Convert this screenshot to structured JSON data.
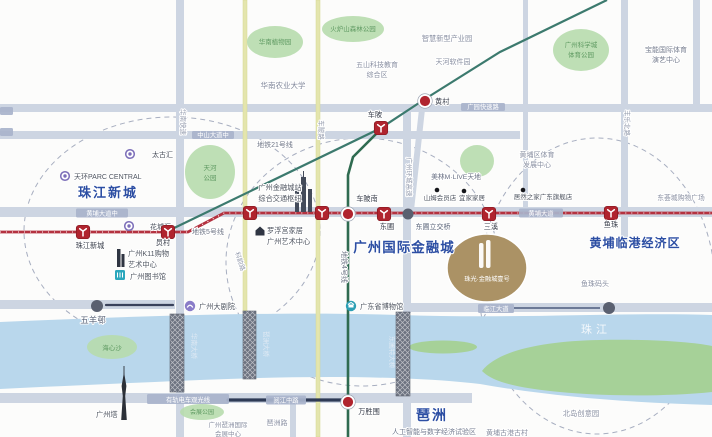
{
  "palette": {
    "road": "#cdd5e2",
    "yellow_road": "#e4e5ad",
    "yellow_edge": "#d6d792",
    "river": "#b9d7ec",
    "island": "#a6d198",
    "park": "#b7dcad",
    "park_text": "#5f9a62",
    "badge": "#a9b4cb",
    "line5": "#b43240",
    "line4": "#2f6b50",
    "line21": "#3c7a6e",
    "tram": "#2e3a55",
    "station_red": "#b0242e",
    "blue_label": "#2c4ea3",
    "gold": "#ab9265",
    "dash": "#a7aec0",
    "gray_text": "#8a90a2",
    "dark_text": "#4e545f",
    "station_text": "#3b404c",
    "vtext": "#959cae",
    "bridge": "#6c7280",
    "dot": "#5a6070",
    "white_text": "#f4f8fc",
    "bridge_text": "#e0eaf4"
  },
  "dashed_circles": [
    {
      "id": "district-circle-zhujiang-new-town",
      "cx": 172,
      "cy": 231,
      "rx": 148,
      "ry": 114
    },
    {
      "id": "district-circle-financial-city",
      "cx": 362,
      "cy": 262,
      "rx": 136,
      "ry": 124
    },
    {
      "id": "district-circle-huangpu-port",
      "cx": 597,
      "cy": 286,
      "rx": 118,
      "ry": 148
    }
  ],
  "roads_under": [
    {
      "id": "road-guangyuan-expressway",
      "kind": "rect",
      "x": 0,
      "y": 104,
      "w": 712,
      "h": 8
    },
    {
      "id": "road-zhongshan-avenue-middle",
      "kind": "rect",
      "x": 0,
      "y": 131,
      "w": 520,
      "h": 8
    },
    {
      "id": "road-huangpu-avenue",
      "kind": "rect",
      "x": 0,
      "y": 207,
      "w": 712,
      "h": 10
    },
    {
      "id": "road-wuyangcun",
      "kind": "rect",
      "x": 0,
      "y": 300,
      "w": 175,
      "h": 9
    },
    {
      "id": "road-huanan-expressway",
      "kind": "rect",
      "x": 176,
      "y": 0,
      "w": 8,
      "h": 316
    },
    {
      "id": "road-ring-expressway",
      "kind": "rect",
      "x": 403,
      "y": 108,
      "w": 8,
      "h": 205
    },
    {
      "id": "road-fengle-north-road",
      "kind": "rect",
      "x": 621,
      "y": 0,
      "w": 7,
      "h": 245
    },
    {
      "id": "road-right-edge",
      "kind": "rect",
      "x": 693,
      "y": 0,
      "w": 7,
      "h": 110
    },
    {
      "id": "road-dashadi",
      "kind": "rect",
      "x": 523,
      "y": 0,
      "w": 5,
      "h": 210
    },
    {
      "id": "road-huangcun-link",
      "kind": "line",
      "x1": 423,
      "y1": 100,
      "x2": 411,
      "y2": 210,
      "w": 6
    },
    {
      "id": "road-keyun-road",
      "kind": "yrect",
      "x": 243,
      "y": 0,
      "w": 4,
      "h": 312
    }
  ],
  "roads_over": [
    {
      "id": "road-linjiang-avenue",
      "kind": "rect",
      "x": 405,
      "y": 303,
      "w": 307,
      "h": 9
    },
    {
      "id": "road-yuejiang-road",
      "kind": "rect",
      "x": 0,
      "y": 393,
      "w": 472,
      "h": 10
    },
    {
      "id": "road-huanan-expressway-south",
      "kind": "rect",
      "x": 176,
      "y": 392,
      "w": 8,
      "h": 45
    },
    {
      "id": "road-ring-expressway-south",
      "kind": "rect",
      "x": 403,
      "y": 395,
      "w": 8,
      "h": 42
    },
    {
      "id": "road-pazhou-vertical",
      "kind": "rect",
      "x": 290,
      "y": 403,
      "w": 6,
      "h": 34
    },
    {
      "id": "road-chebei-road",
      "kind": "yrect",
      "x": 316,
      "y": 0,
      "w": 4,
      "h": 437
    }
  ],
  "river": {
    "id": "pearl-river",
    "path": "M0,322 C140,316 280,311 400,315 C520,319 620,312 712,315 L712,405 C640,403 560,398 480,384 C400,375 300,376 200,380 C130,383 60,386 0,389 Z",
    "islands": [
      {
        "id": "island-dajisha",
        "kind": "path",
        "path": "M482,371 C498,350 545,341 600,340 C652,339 692,342 712,346 L712,392 C664,397 602,396 560,392 C520,388 494,383 482,371 Z"
      },
      {
        "id": "island-sliver",
        "kind": "ellipse",
        "cx": 443,
        "cy": 347,
        "rx": 34,
        "ry": 6.5
      }
    ]
  },
  "bridges": [
    {
      "id": "huanan-bridge",
      "label": "华南大桥",
      "x": 170,
      "y": 314,
      "w": 14,
      "h": 78,
      "lx": 192,
      "ly": 346
    },
    {
      "id": "pazhou-bridge",
      "label": "琶洲大桥",
      "x": 243,
      "y": 311,
      "w": 13,
      "h": 68,
      "lx": 264,
      "ly": 344
    },
    {
      "id": "dongpu-bridge",
      "label": "东圃特大桥",
      "x": 396,
      "y": 312,
      "w": 14,
      "h": 84,
      "lx": 390,
      "ly": 352
    }
  ],
  "extra_lines": [
    {
      "id": "tram-track",
      "path": "M228,400 L344,400",
      "color": "#2e3a55",
      "w": 3.2,
      "cap": "round"
    },
    {
      "id": "wuyangcun-stripe",
      "path": "M106,305 L173,305",
      "color": "#39415a",
      "w": 2.2,
      "cap": "round"
    },
    {
      "id": "linjiang-stripe",
      "path": "M514,308 L600,308",
      "color": "#4d5b7c",
      "w": 1.6,
      "cap": "butt"
    }
  ],
  "metro_lines": [
    {
      "id": "metro-line-21",
      "label": "地铁21号线",
      "path": "M170,230 L381,128 L425,99 L500,52 L607,0",
      "color": "#3c7a6e",
      "w": 2.2,
      "lx": 275,
      "ly": 147
    },
    {
      "id": "metro-line-4",
      "label": "地铁4号线",
      "path": "M381,129 L353,157 L348,175 L348,437",
      "color": "#2f6b50",
      "w": 2.6,
      "lx": 342,
      "ly": 267,
      "rotate": 90
    },
    {
      "id": "metro-line-5",
      "label": "地铁5号线",
      "path": "M0,232 L188,232 L224,213 L712,213",
      "color": "#b43240",
      "w": 2.8,
      "lx": 208,
      "ly": 234,
      "ticks": true
    }
  ],
  "stations": [
    {
      "id": "station-zhujiang-new-town",
      "name": "珠江新城",
      "type": "logo",
      "x": 83,
      "y": 232,
      "lx": 90,
      "ly": 248
    },
    {
      "id": "station-yuancun",
      "name": "员村",
      "type": "logo",
      "x": 168,
      "y": 232,
      "lx": 163,
      "ly": 245
    },
    {
      "id": "station-financial-city",
      "name": "",
      "type": "logo",
      "x": 250,
      "y": 213
    },
    {
      "id": "station-unnamed",
      "name": "",
      "type": "logo",
      "x": 322,
      "y": 213
    },
    {
      "id": "station-dongpu",
      "name": "东圃",
      "type": "logo",
      "x": 384,
      "y": 214,
      "lx": 387,
      "ly": 229
    },
    {
      "id": "station-sanxi",
      "name": "三溪",
      "type": "logo",
      "x": 489,
      "y": 214,
      "lx": 491,
      "ly": 229
    },
    {
      "id": "station-yuzhu",
      "name": "鱼珠",
      "type": "logo",
      "x": 611,
      "y": 213,
      "lx": 611,
      "ly": 227
    },
    {
      "id": "station-chebei",
      "name": "车陂",
      "type": "logo",
      "x": 381,
      "y": 128,
      "lx": 375,
      "ly": 117
    },
    {
      "id": "station-chebeinan",
      "name": "车陂南",
      "type": "interchange",
      "x": 348,
      "y": 214,
      "lx": 367,
      "ly": 201
    },
    {
      "id": "station-huangcun",
      "name": "黄村",
      "type": "interchange",
      "x": 425,
      "y": 101,
      "lx": 435,
      "ly": 104,
      "anchor": "start"
    },
    {
      "id": "station-wanshengwei",
      "name": "万胜围",
      "type": "interchange",
      "x": 348,
      "y": 402,
      "lx": 369,
      "ly": 414
    }
  ],
  "road_dots": [
    {
      "id": "dongpu-interchange-dot",
      "label": "东圃立交桥",
      "x": 408,
      "y": 214,
      "r": 5.5,
      "lx": 433,
      "ly": 229
    },
    {
      "id": "linjiang-avenue-dot",
      "label": "",
      "x": 609,
      "y": 308,
      "r": 6
    },
    {
      "id": "wuyangcun-dot",
      "label": "五羊邨",
      "x": 97,
      "y": 306,
      "r": 6,
      "lx": 93,
      "ly": 323,
      "size": 8.5
    }
  ],
  "poi_dots": [
    {
      "id": "poi-sams-club",
      "label": "山姆会员店",
      "x": 437,
      "y": 190,
      "lx": 440,
      "ly": 200
    },
    {
      "id": "poi-ikea",
      "label": "宜家家居",
      "x": 464,
      "y": 191,
      "lx": 472,
      "ly": 200
    },
    {
      "id": "poi-easyhome",
      "label": "居然之家广东旗舰店",
      "x": 523,
      "y": 190,
      "lx": 543,
      "ly": 199
    }
  ],
  "ring_pois": [
    {
      "id": "poi-taikoo-hui",
      "label": "太古汇",
      "x": 130,
      "y": 154,
      "lx": 152,
      "ly": 157
    },
    {
      "id": "poi-parc-central",
      "label": "天环PARC CENTRAL",
      "x": 65,
      "y": 176,
      "lx": 74,
      "ly": 179,
      "anchor": "start"
    },
    {
      "id": "poi-huachenghui",
      "label": "花城汇",
      "x": 129,
      "y": 226,
      "lx": 150,
      "ly": 229
    }
  ],
  "icon_pois": [
    {
      "id": "poi-k11",
      "icon": "building",
      "x": 122,
      "y": 258,
      "lines": [
        "广州K11购物",
        "艺术中心"
      ],
      "lx": 128,
      "ly": 256,
      "anchor": "start"
    },
    {
      "id": "poi-guangzhou-library",
      "icon": "library",
      "x": 120,
      "y": 275,
      "lines": [
        "广州图书馆"
      ],
      "lx": 130,
      "ly": 279,
      "anchor": "start"
    },
    {
      "id": "poi-opera-house",
      "icon": "opera",
      "x": 190,
      "y": 306,
      "lines": [
        "广州大剧院"
      ],
      "lx": 199,
      "ly": 309,
      "anchor": "start"
    },
    {
      "id": "poi-guangdong-museum",
      "icon": "museum",
      "x": 351,
      "y": 306,
      "lines": [
        "广东省博物馆"
      ],
      "lx": 360,
      "ly": 309,
      "anchor": "start"
    },
    {
      "id": "poi-louvre-home",
      "icon": "home",
      "x": 260,
      "y": 231,
      "lines": [
        "罗浮宫家居",
        "广州艺术中心"
      ],
      "lx": 267,
      "ly": 233,
      "anchor": "start"
    },
    {
      "id": "poi-financial-city-hub",
      "icon": "buildings",
      "x": 302,
      "y": 195,
      "lines": [
        "广州金融城站",
        "综合交通枢纽"
      ],
      "lx": 280,
      "ly": 190,
      "anchor": "middle"
    },
    {
      "id": "poi-canton-tower",
      "icon": "tower",
      "x": 124,
      "y": 392,
      "lines": [
        "广州塔"
      ],
      "lx": 96,
      "ly": 417,
      "anchor": "start"
    }
  ],
  "parks": [
    {
      "id": "park-botanical-garden",
      "lines": [
        "华南植物园"
      ],
      "cx": 275,
      "cy": 42,
      "rx": 28,
      "ry": 16,
      "ty": 44
    },
    {
      "id": "park-huolushan-forest",
      "lines": [
        "火炉山森林公园"
      ],
      "cx": 353,
      "cy": 29,
      "rx": 31,
      "ry": 13,
      "ty": 31
    },
    {
      "id": "park-science-city-sports",
      "lines": [
        "广州科学城",
        "体育公园"
      ],
      "cx": 581,
      "cy": 50,
      "rx": 28,
      "ry": 21,
      "ty": 47
    },
    {
      "id": "park-tianhe",
      "lines": [
        "天河",
        "公园"
      ],
      "cx": 210,
      "cy": 172,
      "rx": 25,
      "ry": 27,
      "ty": 170
    },
    {
      "id": "park-small-green",
      "lines": [],
      "cx": 477,
      "cy": 161,
      "rx": 17,
      "ry": 16,
      "ty": 0
    },
    {
      "id": "park-haixinsha",
      "lines": [
        "海心沙"
      ],
      "cx": 112,
      "cy": 347,
      "rx": 25,
      "ry": 12,
      "ty": 350
    },
    {
      "id": "park-exhibition",
      "lines": [
        "会展公园"
      ],
      "cx": 202,
      "cy": 412,
      "rx": 22,
      "ry": 8,
      "ty": 414,
      "size": 6
    }
  ],
  "badges": [
    {
      "id": "badge-zhongshan-avenue-middle",
      "text": "中山大道中",
      "x": 192,
      "y": 131,
      "w": 42,
      "h": 8
    },
    {
      "id": "badge-guangyuan-expressway",
      "text": "广园快速路",
      "x": 461,
      "y": 103,
      "w": 44,
      "h": 8
    },
    {
      "id": "badge-huangpu-avenue-middle",
      "text": "黄埔大道中",
      "x": 76,
      "y": 208.5,
      "w": 52,
      "h": 9
    },
    {
      "id": "badge-huangpu-avenue",
      "text": "黄埔大道",
      "x": 519,
      "y": 208.5,
      "w": 44,
      "h": 9
    },
    {
      "id": "badge-linjiang-avenue",
      "text": "临江大道",
      "x": 478,
      "y": 304,
      "w": 36,
      "h": 9
    },
    {
      "id": "badge-yuejiang-middle-road",
      "text": "阅江中路",
      "x": 266,
      "y": 395.5,
      "w": 40,
      "h": 9
    },
    {
      "id": "badge-tram-line",
      "text": "有轨电车观光线",
      "x": 147,
      "y": 394,
      "w": 82,
      "h": 10
    },
    {
      "id": "badge-left-stub-1",
      "text": "",
      "x": 0,
      "y": 107,
      "w": 13,
      "h": 8
    },
    {
      "id": "badge-left-stub-2",
      "text": "",
      "x": 0,
      "y": 128,
      "w": 13,
      "h": 8
    }
  ],
  "vtexts": [
    {
      "id": "vlabel-huanan-expressway",
      "text": "华南快速",
      "x": 181,
      "y": 122,
      "rotate": 90
    },
    {
      "id": "vlabel-keyun-road",
      "text": "科韵路",
      "x": 238,
      "y": 262,
      "rotate": 72
    },
    {
      "id": "vlabel-chebei-road",
      "text": "车陂路",
      "x": 319,
      "y": 130,
      "rotate": 90
    },
    {
      "id": "vlabel-ring-expressway",
      "text": "广州环城高速",
      "x": 407,
      "y": 177,
      "rotate": 90
    },
    {
      "id": "vlabel-fengle-north-road",
      "text": "丰乐北路",
      "x": 625,
      "y": 123,
      "rotate": 90
    }
  ],
  "texts": [
    {
      "id": "label-smart-industry-park",
      "lines": [
        "智慧新型产业园"
      ],
      "x": 447,
      "y": 41,
      "size": 7.2,
      "color": "#8a90a2"
    },
    {
      "id": "label-baoneng-center",
      "lines": [
        "宝能国际体育",
        "演艺中心"
      ],
      "x": 666,
      "y": 52,
      "dy": 10,
      "size": 7,
      "color": "#767d8e"
    },
    {
      "id": "label-tianhe-software-park",
      "lines": [
        "天河软件园"
      ],
      "x": 453,
      "y": 64,
      "size": 7,
      "color": "#8a90a2"
    },
    {
      "id": "label-wushan-tech-area",
      "lines": [
        "五山科技教育",
        "综合区"
      ],
      "x": 377,
      "y": 67,
      "dy": 10,
      "size": 7,
      "color": "#8a90a2"
    },
    {
      "id": "label-south-china-agri-univ",
      "lines": [
        "华南农业大学"
      ],
      "x": 283,
      "y": 88,
      "size": 7.5,
      "color": "#80879a"
    },
    {
      "id": "label-huangpu-sports-center",
      "lines": [
        "黄埔区体育",
        "发展中心"
      ],
      "x": 537,
      "y": 157,
      "dy": 10,
      "size": 7,
      "color": "#8a90a2"
    },
    {
      "id": "label-meilin-mlive",
      "lines": [
        "美林M·LIVE天地"
      ],
      "x": 456,
      "y": 179,
      "size": 6.8,
      "color": "#6a7184"
    },
    {
      "id": "label-donghuicheng-mall",
      "lines": [
        "东荟城购物广场"
      ],
      "x": 681,
      "y": 200,
      "size": 6.8,
      "color": "#8a90a2"
    },
    {
      "id": "label-yuzhu-wharf",
      "lines": [
        "鱼珠码头"
      ],
      "x": 595,
      "y": 286,
      "size": 7,
      "color": "#8a90a2"
    },
    {
      "id": "label-north-island-creative-park",
      "lines": [
        "北岛创意园"
      ],
      "x": 581,
      "y": 416,
      "size": 7.3,
      "color": "#8a90a2"
    },
    {
      "id": "label-huangpu-ancient-port",
      "lines": [
        "黄埔古港古村"
      ],
      "x": 507,
      "y": 435,
      "size": 7,
      "color": "#8a90a2"
    },
    {
      "id": "label-pazhou-road",
      "lines": [
        "琶洲路"
      ],
      "x": 277,
      "y": 425,
      "size": 7,
      "color": "#8a90a2"
    },
    {
      "id": "label-exhibition-center",
      "lines": [
        "广州琶洲国际",
        "会展中心"
      ],
      "x": 228,
      "y": 427,
      "dy": 9,
      "size": 6.5,
      "color": "#8a90a2"
    },
    {
      "id": "label-ai-digital-zone",
      "lines": [
        "人工智能与数字经济试验区"
      ],
      "x": 434,
      "y": 434,
      "size": 7,
      "color": "#717a8e"
    },
    {
      "id": "label-pearl-river",
      "lines": [
        "珠江"
      ],
      "x": 596,
      "y": 333,
      "size": 11,
      "color": "#f4f8fc",
      "ls": 4,
      "nohalo": true
    }
  ],
  "area_labels": [
    {
      "id": "area-zhujiang-new-town",
      "text": "珠江新城",
      "x": 108,
      "y": 197,
      "size": 13,
      "ls": 2
    },
    {
      "id": "area-intl-financial-city",
      "text": "广州国际金融城",
      "x": 404,
      "y": 252,
      "size": 13.5,
      "ls": 1
    },
    {
      "id": "area-huangpu-port-zone",
      "text": "黄埔临港经济区",
      "x": 635,
      "y": 247,
      "size": 12,
      "ls": 1
    },
    {
      "id": "area-pazhou",
      "text": "琶洲",
      "x": 432,
      "y": 420,
      "size": 14,
      "ls": 2
    }
  ],
  "project": {
    "id": "project-zhuguang-financial-city-no1",
    "name": "珠光·金融城壹号",
    "cx": 487,
    "cy": 268,
    "rx": 40,
    "ry": 34,
    "ty": 281
  }
}
